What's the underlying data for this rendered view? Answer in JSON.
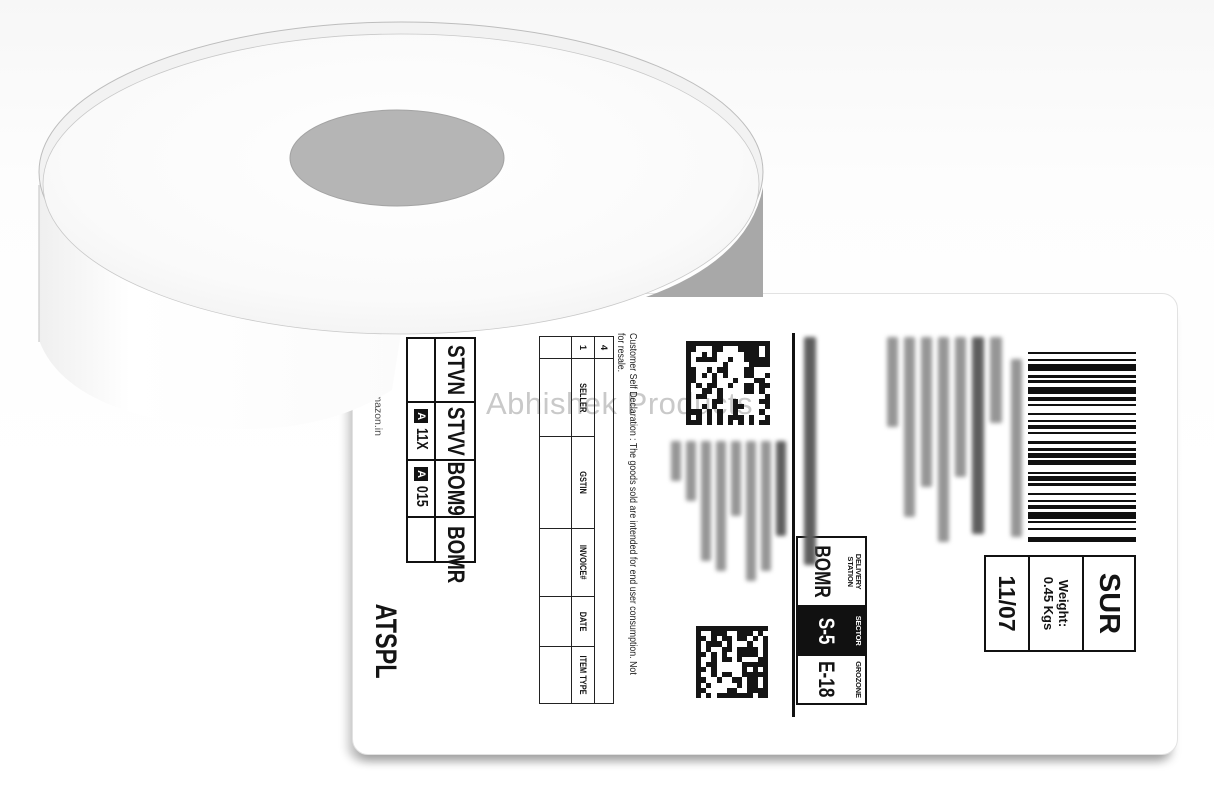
{
  "photo": {
    "watermark": "Abhishek Products",
    "roll_core_color": "#b5b5b5"
  },
  "label": {
    "barcode": {
      "pattern": "1211321112312113121121131211212311211312112131121321"
    },
    "barcode_caption_lines": [
      [
        178,
        11,
        0
      ]
    ],
    "service_box": {
      "service": "SUR",
      "weight_label": "Weight:",
      "weight_value": "0.45 Kgs",
      "ship_date": "11/07"
    },
    "ship_to_redacted_lines": [
      [
        86,
        12,
        0
      ],
      [
        197,
        12,
        1
      ],
      [
        140,
        11,
        0
      ],
      [
        205,
        11,
        0
      ],
      [
        150,
        11,
        0
      ],
      [
        180,
        11,
        0
      ],
      [
        90,
        11,
        0
      ]
    ],
    "order_id_redacted_lines": [
      [
        228,
        12,
        1
      ]
    ],
    "routing_box": {
      "cells": [
        {
          "label_line1": "DELIVERY",
          "label_line2": "STATION",
          "value": "BOMR",
          "inverted": false
        },
        {
          "label_line1": "SECTOR",
          "label_line2": "",
          "value": "S-5",
          "inverted": true
        },
        {
          "label_line1": "GROZONE",
          "label_line2": "",
          "value": "E-18",
          "inverted": false
        }
      ]
    },
    "qr_codes": [
      {
        "seed": 7,
        "cells": 16
      },
      {
        "seed": 13,
        "cells": 14
      }
    ],
    "return_redacted_lines": [
      [
        95,
        10,
        1
      ],
      [
        130,
        10,
        0
      ],
      [
        140,
        10,
        0
      ],
      [
        75,
        10,
        0
      ],
      [
        130,
        10,
        0
      ],
      [
        120,
        10,
        0
      ],
      [
        60,
        10,
        0
      ],
      [
        40,
        10,
        0
      ]
    ],
    "declaration_line1": "Customer Self Declaration : The goods sold are intended for end user consumption. Not",
    "declaration_line2": "for resale.",
    "table": {
      "corner_top": "4",
      "corner_mid": "1",
      "headers": [
        "SELLER",
        "GSTIN",
        "INVOICE#",
        "DATE",
        "ITEM TYPE"
      ]
    },
    "sort_codes": {
      "row1": [
        "STVN",
        "STVV",
        "BOM9",
        "BOMR"
      ],
      "row2": [
        {
          "badge": "",
          "code": ""
        },
        {
          "badge": "A",
          "code": "11X"
        },
        {
          "badge": "A",
          "code": "015"
        },
        {
          "badge": "",
          "code": ""
        }
      ]
    },
    "carrier": "ATSPL",
    "footer": "Sold on: www.amazon.in"
  }
}
